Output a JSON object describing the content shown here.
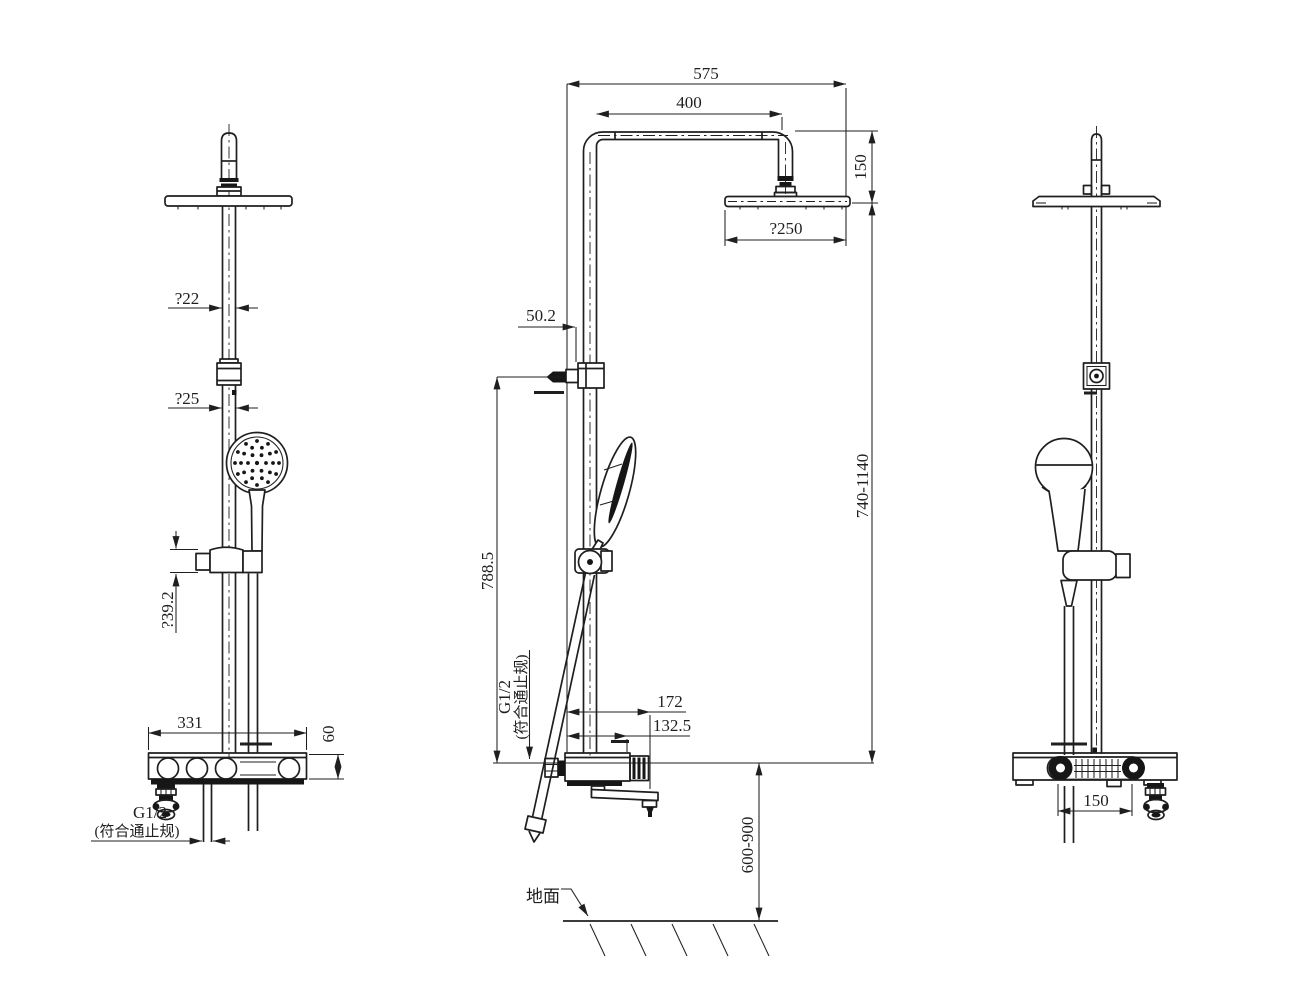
{
  "colors": {
    "line": "#1f1f1f",
    "background": "#ffffff"
  },
  "labels": {
    "left_view": {
      "dia_upper": "?22",
      "dia_lower": "?25",
      "dia_bracket": "?39.2",
      "deck_width": "331",
      "deck_height": "60",
      "thread": "G1/2",
      "thread_note": "(符合通止规)"
    },
    "center_view": {
      "overall_width": "575",
      "arm_length": "400",
      "head_drop": "150",
      "head_dia": "?250",
      "wall_offset": "50.2",
      "bar_height": "788.5",
      "spout_reach": "172",
      "body_depth": "132.5",
      "riser_height": "740-1140",
      "install_height": "600-900",
      "thread": "G1/2",
      "thread_note": "(符合通止规)",
      "ground": "地面"
    },
    "right_view": {
      "outlet_offset": "150"
    }
  }
}
